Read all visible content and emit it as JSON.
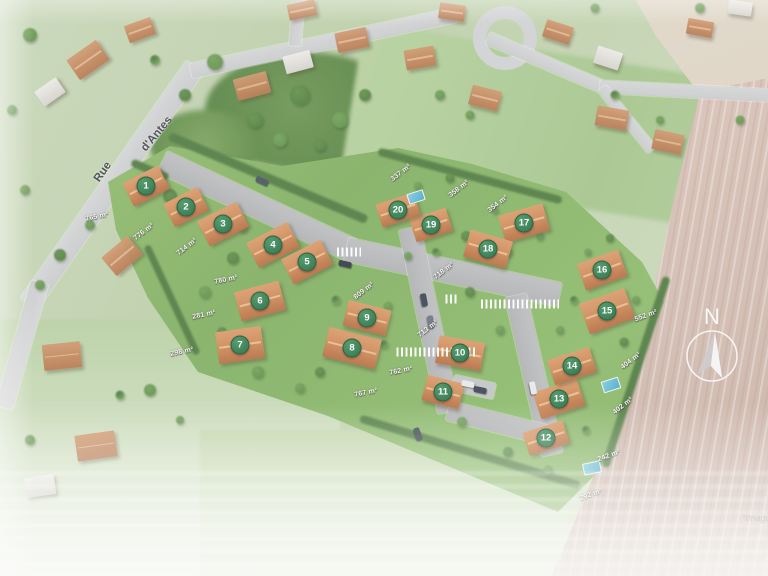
{
  "street": {
    "word1": "Rue",
    "word2": "d'Antes"
  },
  "compass": {
    "label": "N"
  },
  "watermark": "*Image",
  "lots": [
    {
      "num": "1",
      "x": 146,
      "y": 186,
      "house": [
        40,
        26,
        -27
      ]
    },
    {
      "num": "2",
      "x": 186,
      "y": 207,
      "house": [
        38,
        26,
        -27
      ]
    },
    {
      "num": "3",
      "x": 223,
      "y": 224,
      "house": [
        44,
        28,
        -27
      ]
    },
    {
      "num": "4",
      "x": 273,
      "y": 245,
      "house": [
        46,
        28,
        -27
      ]
    },
    {
      "num": "5",
      "x": 307,
      "y": 262,
      "house": [
        44,
        28,
        -27
      ]
    },
    {
      "num": "6",
      "x": 260,
      "y": 301,
      "house": [
        46,
        30,
        -15
      ]
    },
    {
      "num": "7",
      "x": 240,
      "y": 345,
      "house": [
        46,
        32,
        -8
      ]
    },
    {
      "num": "8",
      "x": 352,
      "y": 348,
      "house": [
        54,
        30,
        14
      ]
    },
    {
      "num": "9",
      "x": 367,
      "y": 318,
      "house": [
        44,
        26,
        14
      ]
    },
    {
      "num": "10",
      "x": 460,
      "y": 353,
      "house": [
        46,
        28,
        10
      ]
    },
    {
      "num": "11",
      "x": 443,
      "y": 392,
      "house": [
        38,
        26,
        14
      ]
    },
    {
      "num": "12",
      "x": 546,
      "y": 438,
      "house": [
        42,
        24,
        -18
      ]
    },
    {
      "num": "13",
      "x": 559,
      "y": 399,
      "house": [
        46,
        28,
        -18
      ]
    },
    {
      "num": "14",
      "x": 572,
      "y": 366,
      "house": [
        44,
        26,
        -18
      ]
    },
    {
      "num": "15",
      "x": 607,
      "y": 311,
      "house": [
        48,
        32,
        -20
      ]
    },
    {
      "num": "16",
      "x": 602,
      "y": 270,
      "house": [
        44,
        28,
        -20
      ]
    },
    {
      "num": "17",
      "x": 524,
      "y": 223,
      "house": [
        46,
        28,
        -16
      ]
    },
    {
      "num": "18",
      "x": 488,
      "y": 249,
      "house": [
        44,
        28,
        16
      ]
    },
    {
      "num": "19",
      "x": 431,
      "y": 225,
      "house": [
        38,
        24,
        -18
      ]
    },
    {
      "num": "20",
      "x": 398,
      "y": 210,
      "house": [
        40,
        24,
        -18
      ]
    }
  ],
  "area_labels": [
    {
      "text": "765 m²",
      "x": 97,
      "y": 217,
      "rot": -12
    },
    {
      "text": "776 m²",
      "x": 144,
      "y": 232,
      "rot": -38
    },
    {
      "text": "714 m²",
      "x": 187,
      "y": 247,
      "rot": -38
    },
    {
      "text": "780 m²",
      "x": 226,
      "y": 280,
      "rot": -12
    },
    {
      "text": "281 m²",
      "x": 204,
      "y": 315,
      "rot": -12
    },
    {
      "text": "298 m²",
      "x": 182,
      "y": 352,
      "rot": -12
    },
    {
      "text": "809 m²",
      "x": 364,
      "y": 291,
      "rot": -38
    },
    {
      "text": "767 m²",
      "x": 366,
      "y": 393,
      "rot": -12
    },
    {
      "text": "713 m²",
      "x": 428,
      "y": 329,
      "rot": -38
    },
    {
      "text": "762 m²",
      "x": 401,
      "y": 371,
      "rot": -12
    },
    {
      "text": "337 m²",
      "x": 401,
      "y": 173,
      "rot": -38
    },
    {
      "text": "358 m²",
      "x": 459,
      "y": 189,
      "rot": -38
    },
    {
      "text": "354 m²",
      "x": 498,
      "y": 204,
      "rot": -38
    },
    {
      "text": "718 m²",
      "x": 444,
      "y": 271,
      "rot": -38
    },
    {
      "text": "552 m²",
      "x": 646,
      "y": 316,
      "rot": -20
    },
    {
      "text": "404 m²",
      "x": 631,
      "y": 361,
      "rot": -38
    },
    {
      "text": "402 m²",
      "x": 623,
      "y": 406,
      "rot": -38
    },
    {
      "text": "242 m²",
      "x": 609,
      "y": 456,
      "rot": -20
    },
    {
      "text": "292 m²",
      "x": 591,
      "y": 495,
      "rot": -20
    }
  ],
  "scene": {
    "ext_roads": [
      [
        112,
        185,
        290,
        21,
        -55
      ],
      [
        22,
        345,
        130,
        18,
        106
      ],
      [
        323,
        43,
        270,
        15,
        -12
      ],
      [
        544,
        62,
        122,
        13,
        23
      ],
      [
        684,
        91,
        168,
        13,
        3
      ],
      [
        627,
        119,
        80,
        11,
        51
      ],
      [
        297,
        22,
        48,
        12,
        95
      ]
    ],
    "int_roads": [
      [
        257,
        206,
        209,
        24,
        25
      ],
      [
        453,
        272,
        218,
        24,
        12
      ],
      [
        429,
        320,
        188,
        22,
        78
      ],
      [
        534,
        375,
        163,
        22,
        77
      ],
      [
        498,
        423,
        103,
        20,
        14
      ]
    ],
    "parking": [
      [
        474,
        387,
        42,
        16,
        12
      ]
    ],
    "crosswalks": [
      [
        349,
        252,
        24
      ],
      [
        452,
        299,
        13
      ],
      [
        520,
        304,
        78
      ],
      [
        436,
        352,
        79
      ]
    ],
    "hedges": [
      [
        268,
        178,
        215,
        9,
        23
      ],
      [
        470,
        176,
        190,
        8,
        15
      ],
      [
        636,
        372,
        200,
        8,
        108
      ],
      [
        470,
        452,
        230,
        8,
        17
      ],
      [
        172,
        300,
        120,
        7,
        65
      ],
      [
        150,
        170,
        40,
        8,
        23
      ]
    ],
    "tree_colors": [
      "#4f7d3c",
      "#5f8f49",
      "#6fa055",
      "#46743a"
    ],
    "trees": [
      [
        170,
        196,
        14,
        0
      ],
      [
        206,
        227,
        10,
        1
      ],
      [
        243,
        228,
        9,
        1
      ],
      [
        233,
        258,
        12,
        0
      ],
      [
        205,
        292,
        12,
        1
      ],
      [
        222,
        332,
        10,
        0
      ],
      [
        258,
        372,
        12,
        1
      ],
      [
        300,
        388,
        10,
        1
      ],
      [
        336,
        300,
        9,
        2
      ],
      [
        320,
        372,
        10,
        0
      ],
      [
        388,
        306,
        9,
        1
      ],
      [
        384,
        344,
        8,
        2
      ],
      [
        408,
        256,
        8,
        1
      ],
      [
        436,
        252,
        8,
        2
      ],
      [
        466,
        236,
        10,
        0
      ],
      [
        508,
        252,
        9,
        1
      ],
      [
        540,
        236,
        8,
        1
      ],
      [
        470,
        292,
        10,
        0
      ],
      [
        500,
        330,
        9,
        1
      ],
      [
        462,
        422,
        10,
        1
      ],
      [
        508,
        452,
        10,
        0
      ],
      [
        548,
        470,
        9,
        1
      ],
      [
        586,
        430,
        8,
        2
      ],
      [
        624,
        342,
        9,
        0
      ],
      [
        636,
        300,
        8,
        1
      ],
      [
        574,
        300,
        8,
        2
      ],
      [
        560,
        330,
        8,
        1
      ],
      [
        450,
        178,
        9,
        0
      ],
      [
        418,
        186,
        8,
        1
      ],
      [
        495,
        210,
        7,
        1
      ],
      [
        610,
        238,
        8,
        0
      ],
      [
        588,
        252,
        7,
        1
      ],
      [
        60,
        255,
        12,
        0
      ],
      [
        90,
        225,
        10,
        1
      ],
      [
        40,
        285,
        10,
        1
      ],
      [
        215,
        62,
        16,
        1
      ],
      [
        185,
        95,
        12,
        0
      ],
      [
        255,
        120,
        16,
        0
      ],
      [
        300,
        95,
        20,
        0
      ],
      [
        340,
        120,
        16,
        1
      ],
      [
        365,
        95,
        12,
        0
      ],
      [
        280,
        140,
        14,
        1
      ],
      [
        320,
        145,
        12,
        0
      ],
      [
        30,
        35,
        14,
        1
      ],
      [
        12,
        110,
        10,
        1
      ],
      [
        155,
        60,
        10,
        2
      ],
      [
        440,
        95,
        10,
        1
      ],
      [
        470,
        115,
        9,
        1
      ],
      [
        615,
        95,
        9,
        2
      ],
      [
        660,
        120,
        8,
        1
      ],
      [
        740,
        120,
        9,
        1
      ],
      [
        25,
        190,
        10,
        1
      ],
      [
        700,
        8,
        10,
        1
      ],
      [
        595,
        8,
        9,
        1
      ],
      [
        150,
        390,
        12,
        1
      ],
      [
        120,
        395,
        9,
        2
      ],
      [
        180,
        420,
        8,
        1
      ],
      [
        30,
        440,
        10,
        1
      ]
    ],
    "ctx_houses": [
      [
        88,
        60,
        36,
        24,
        -35,
        0
      ],
      [
        50,
        92,
        26,
        18,
        -35,
        1
      ],
      [
        140,
        30,
        28,
        18,
        -20,
        0
      ],
      [
        252,
        86,
        34,
        22,
        -15,
        0
      ],
      [
        298,
        62,
        28,
        18,
        -15,
        1
      ],
      [
        352,
        40,
        32,
        20,
        -12,
        0
      ],
      [
        302,
        10,
        28,
        16,
        -12,
        0
      ],
      [
        420,
        58,
        30,
        20,
        -10,
        0
      ],
      [
        452,
        12,
        26,
        16,
        8,
        0
      ],
      [
        485,
        98,
        30,
        20,
        14,
        0
      ],
      [
        558,
        32,
        28,
        18,
        18,
        0
      ],
      [
        608,
        58,
        26,
        18,
        18,
        1
      ],
      [
        612,
        118,
        32,
        20,
        10,
        0
      ],
      [
        668,
        142,
        30,
        20,
        12,
        0
      ],
      [
        700,
        28,
        26,
        16,
        10,
        0
      ],
      [
        740,
        8,
        24,
        14,
        8,
        1
      ],
      [
        122,
        256,
        34,
        24,
        -40,
        0
      ],
      [
        62,
        356,
        38,
        26,
        -6,
        0
      ],
      [
        96,
        446,
        40,
        26,
        -8,
        0
      ],
      [
        40,
        486,
        30,
        20,
        -8,
        1
      ]
    ],
    "pools": [
      [
        416,
        197,
        15,
        9,
        -18
      ],
      [
        611,
        385,
        16,
        10,
        -18
      ],
      [
        592,
        468,
        16,
        10,
        -12
      ]
    ],
    "cars": [
      [
        262,
        181,
        24,
        "#46525f"
      ],
      [
        345,
        264,
        13,
        "#2f3945"
      ],
      [
        424,
        300,
        79,
        "#39434f"
      ],
      [
        431,
        322,
        79,
        "#6b7480"
      ],
      [
        468,
        384,
        12,
        "#e8e8e8"
      ],
      [
        480,
        390,
        12,
        "#39434f"
      ],
      [
        418,
        434,
        70,
        "#39434f"
      ],
      [
        533,
        388,
        78,
        "#e8e8e8"
      ]
    ]
  }
}
